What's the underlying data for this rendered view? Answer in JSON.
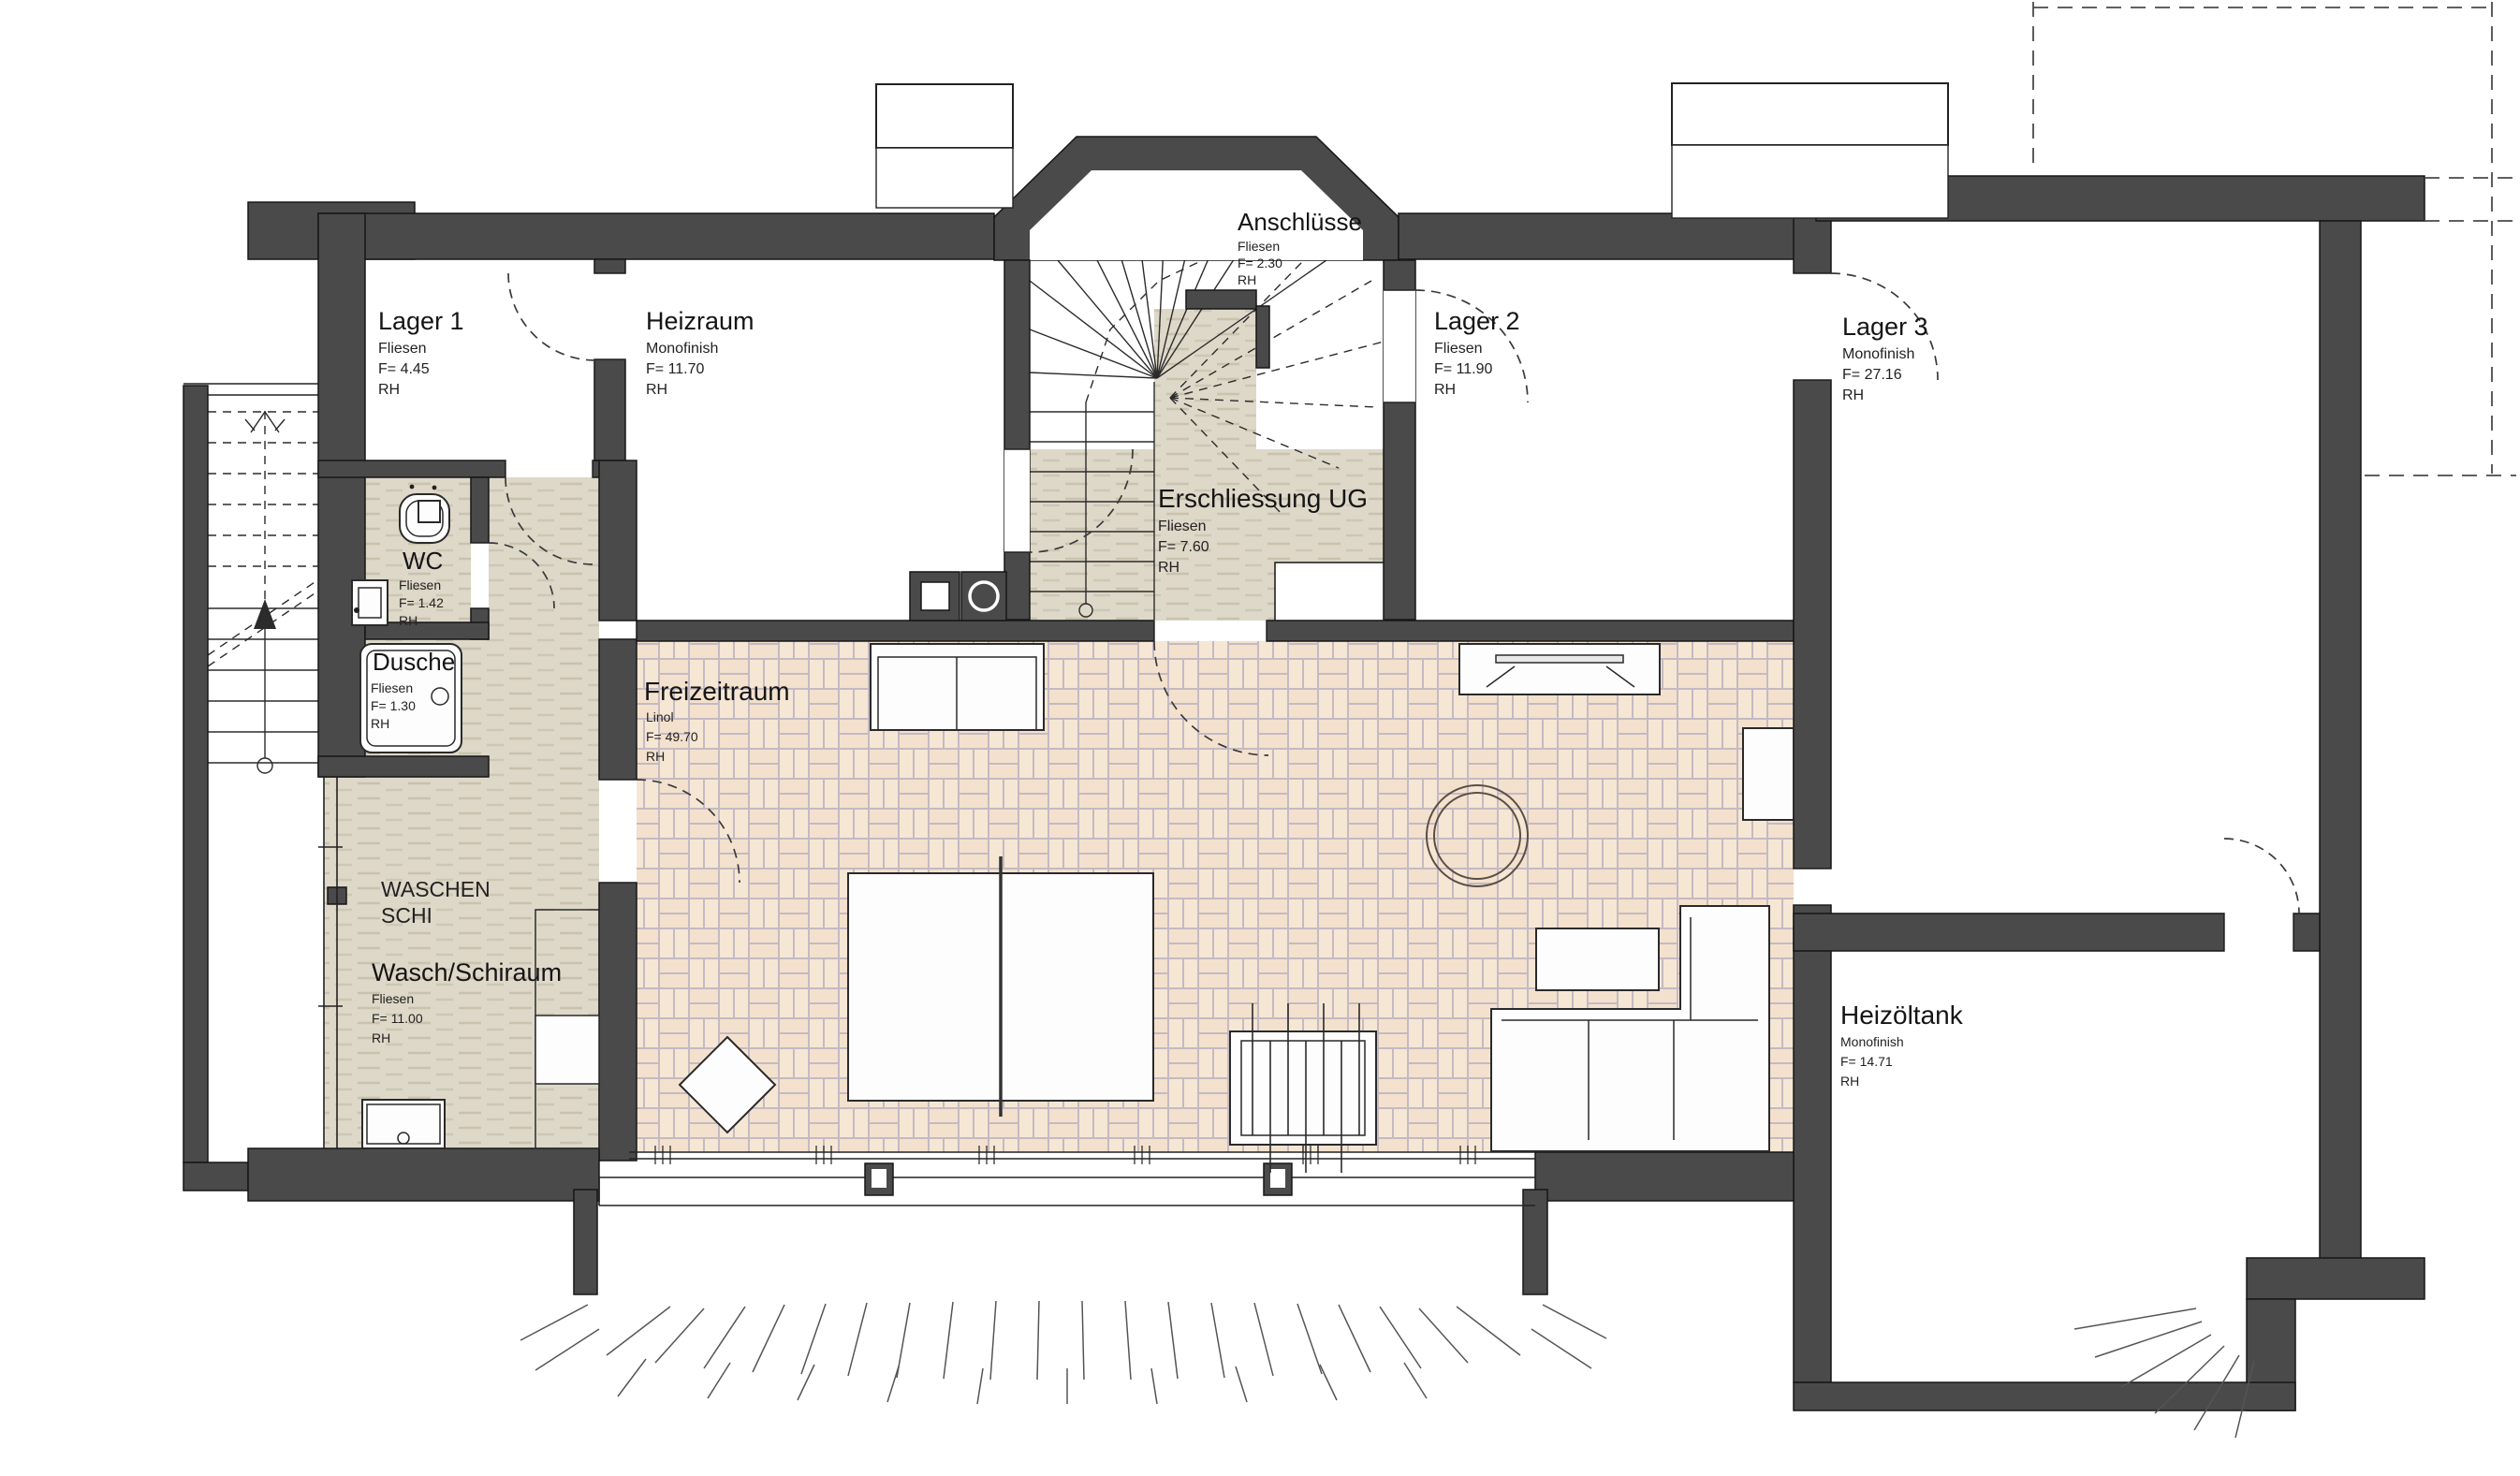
{
  "plan": {
    "rooms": {
      "lager1": {
        "name": "Lager 1",
        "finish": "Fliesen",
        "area": "F= 4.45",
        "height": "RH"
      },
      "heizraum": {
        "name": "Heizraum",
        "finish": "Monofinish",
        "area": "F= 11.70",
        "height": "RH"
      },
      "anschluesse": {
        "name": "Anschlüsse",
        "finish": "Fliesen",
        "area": "F= 2.30",
        "height": "RH"
      },
      "lager2": {
        "name": "Lager 2",
        "finish": "Fliesen",
        "area": "F= 11.90",
        "height": "RH"
      },
      "lager3": {
        "name": "Lager 3",
        "finish": "Monofinish",
        "area": "F= 27.16",
        "height": "RH"
      },
      "erschliessung": {
        "name": "Erschliessung UG",
        "finish": "Fliesen",
        "area": "F= 7.60",
        "height": "RH"
      },
      "wc": {
        "name": "WC",
        "finish": "Fliesen",
        "area": "F= 1.42",
        "height": "RH"
      },
      "dusche": {
        "name": "Dusche",
        "finish": "Fliesen",
        "area": "F= 1.30",
        "height": "RH"
      },
      "waschraum": {
        "name": "Wasch/Schiraum",
        "finish": "Fliesen",
        "area": "F= 11.00",
        "height": "RH"
      },
      "freizeitraum": {
        "name": "Freizeitraum",
        "finish": "Linol",
        "area": "F= 49.70",
        "height": "RH"
      },
      "heizoeltank": {
        "name": "Heizöltank",
        "finish": "Monofinish",
        "area": "F= 14.71",
        "height": "RH"
      }
    },
    "annotations": {
      "wash_line1": "WASCHEN",
      "wash_line2": "SCHI"
    },
    "colors": {
      "wall": "#4a4a4a",
      "tile_beige": "#ddd8c8",
      "tile_beige_dash": "#c8c2ae",
      "linol_base": "#f6e7d5",
      "linol_grid": "#c4bac2",
      "paper": "#ffffff"
    }
  }
}
